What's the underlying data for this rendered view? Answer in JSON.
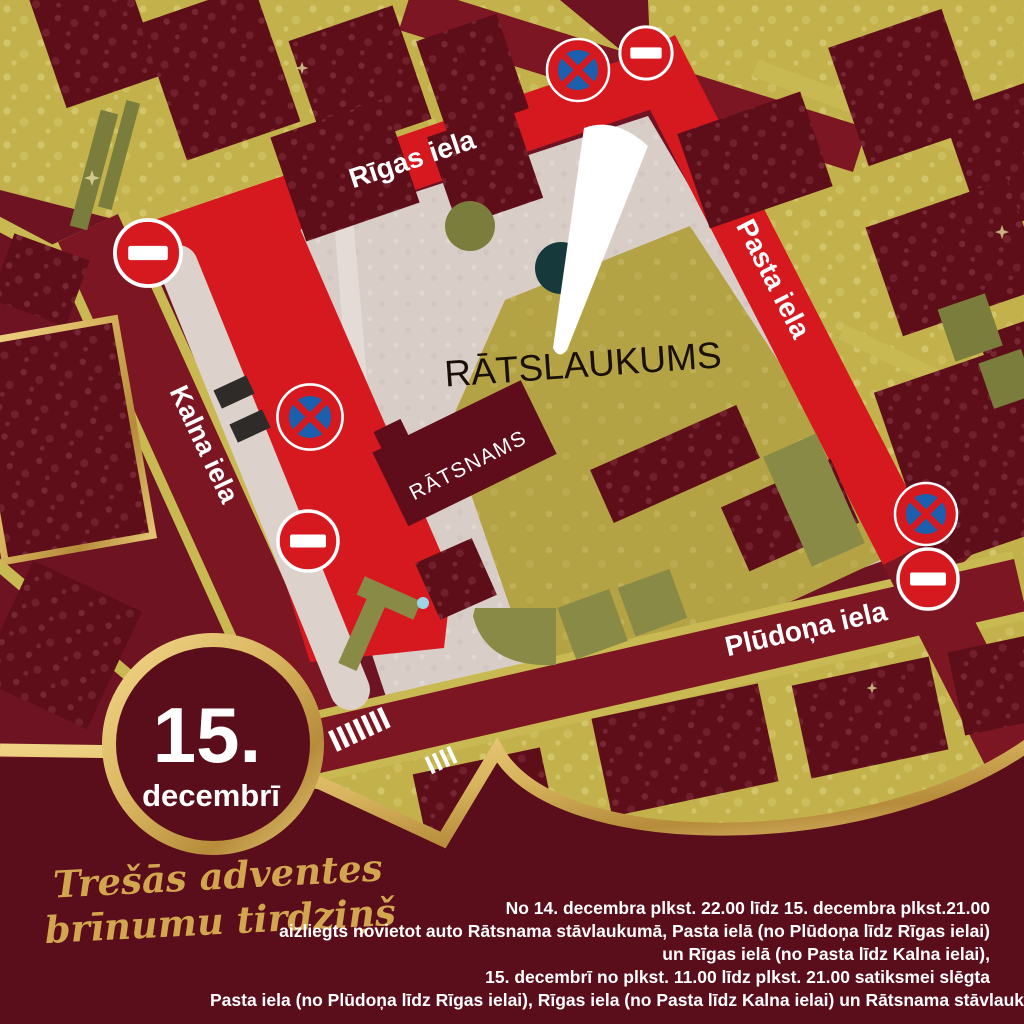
{
  "poster_title": "Trešās adventes brīnumu tirdziņš — satiksmes shēma",
  "badge": {
    "day": "15.",
    "month": "decembrī"
  },
  "tagline": {
    "line1": "Trešās adventes",
    "line2": "brīnumu tirdziņš"
  },
  "map": {
    "street_rigas": "Rīgas iela",
    "street_pasta": "Pasta iela",
    "street_kalna": "Kalna iela",
    "street_pludona": "Plūdoņa iela",
    "square_label": "RĀTSLAUKUMS",
    "town_hall_label": "RĀTSNAMS",
    "icons": {
      "no_entry": "no-entry-sign",
      "no_stopping": "no-stopping-sign",
      "no_entry_count": 4,
      "no_stopping_count": 3
    }
  },
  "notice": {
    "lines": [
      "No 14. decembra plkst. 22.00 līdz 15. decembra plkst.21.00",
      "aizliegts novietot auto Rātsnama stāvlaukumā, Pasta ielā (no Plūdoņa līdz Rīgas ielai)",
      "un Rīgas ielā (no Pasta līdz Kalna ielai),",
      "15. decembrī no plkst. 11.00 līdz plkst. 21.00 satiksmei slēgta",
      "Pasta iela (no Plūdoņa līdz Rīgas ielai), Rīgas iela (no Pasta līdz Kalna ielai) un  Rātsnama stāvlaukums."
    ]
  },
  "colors": {
    "map_background": "#6d1322",
    "building_maroon": "#5d0e19",
    "street_closed_red": "#d6191f",
    "street_open_maroon": "#7c1622",
    "gold_blocks": "#c3b24c",
    "square_pavement_pink": "#d9cdc8",
    "square_olive": "#b3a344",
    "gold_trim": "#d8b45e",
    "footer_maroon": "#5a0d1a",
    "tagline_gold": "#d2a64f",
    "sign_blue": "#1c5fae",
    "text_white": "#ffffff"
  }
}
